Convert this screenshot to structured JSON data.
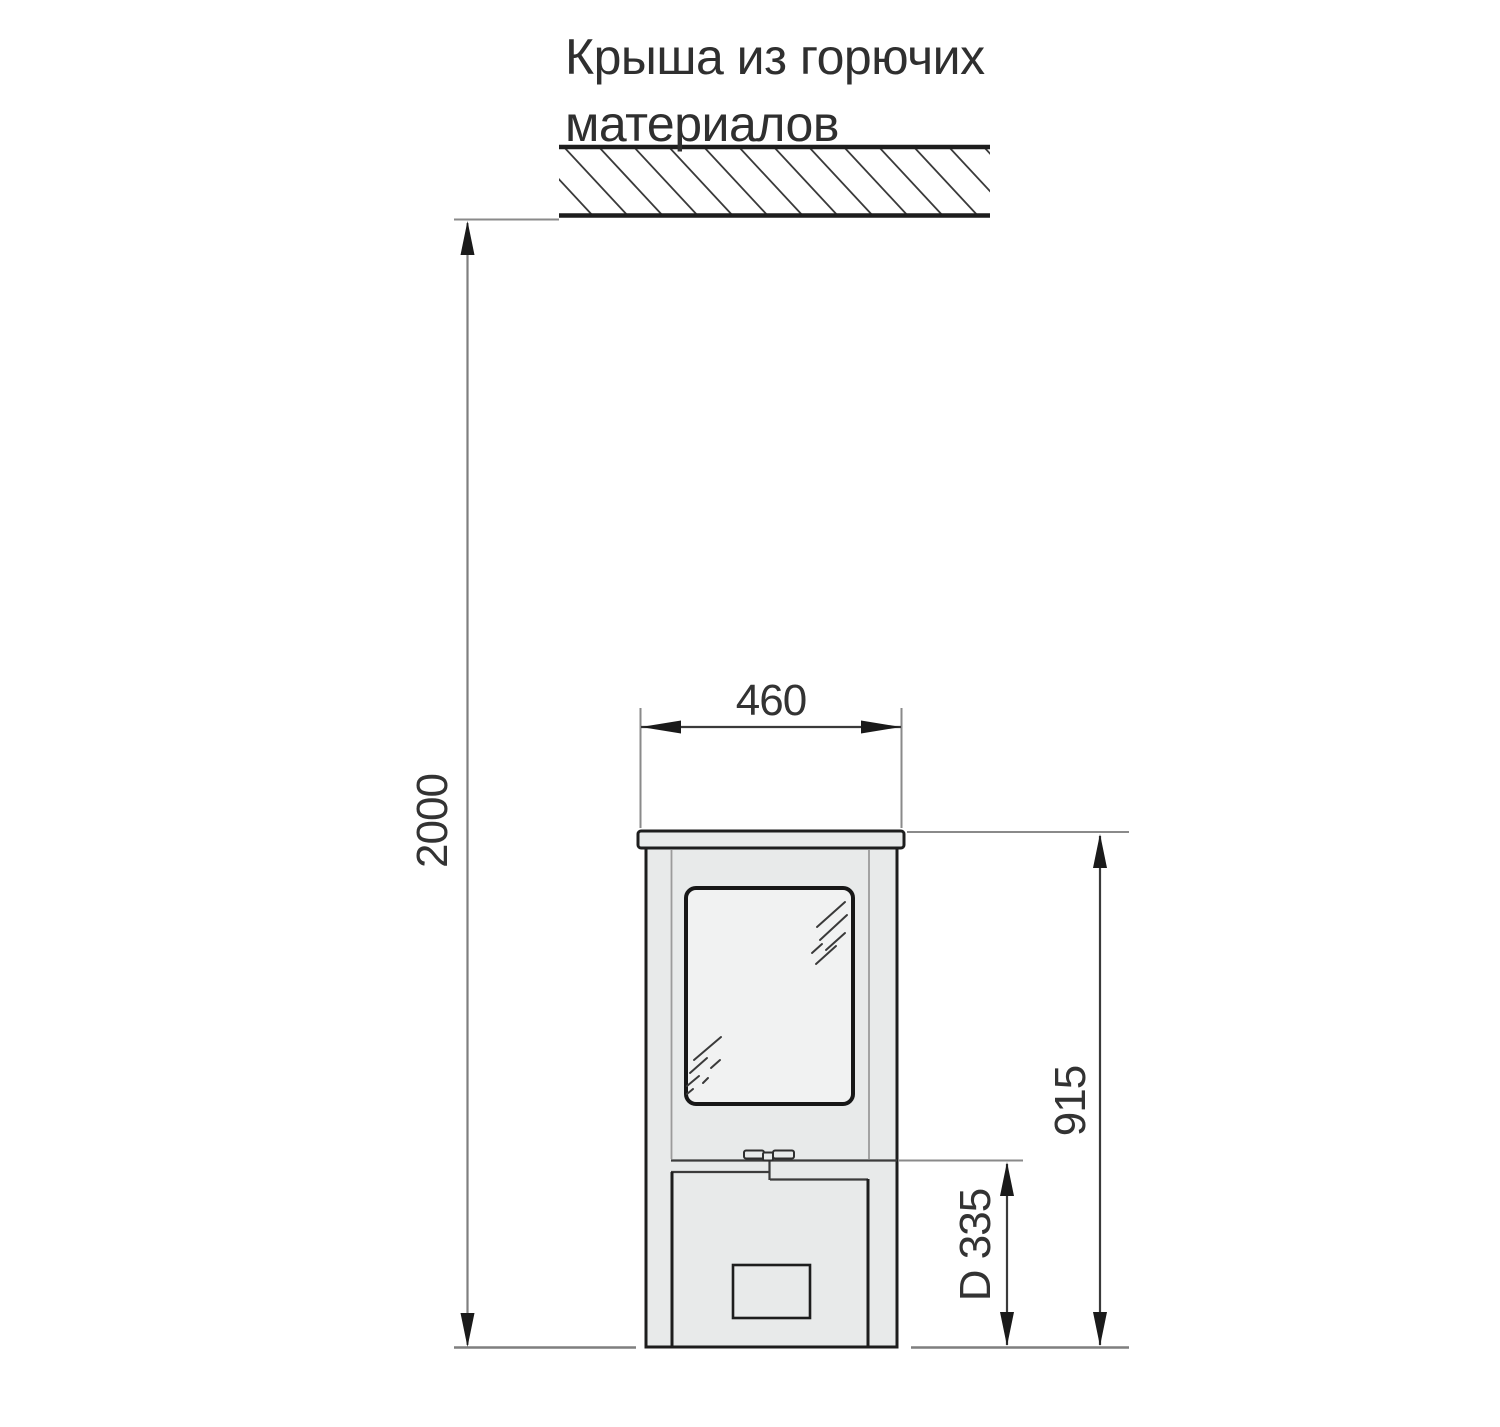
{
  "diagram": {
    "title": {
      "line1": "Крыша из горючих",
      "line2": "материалов"
    },
    "dimensions": {
      "ceiling_clearance_mm": "2000",
      "stove_width_mm": "460",
      "stove_height_mm": "915",
      "flue_center_height_mm": "D 335"
    },
    "colors": {
      "outline": "#1d1d1d",
      "dimension_gray": "#8a8a8a",
      "body_fill": "#e8eaea",
      "glass_fill": "#f1f2f2",
      "text": "#2f2f2f",
      "background": "#ffffff"
    }
  }
}
